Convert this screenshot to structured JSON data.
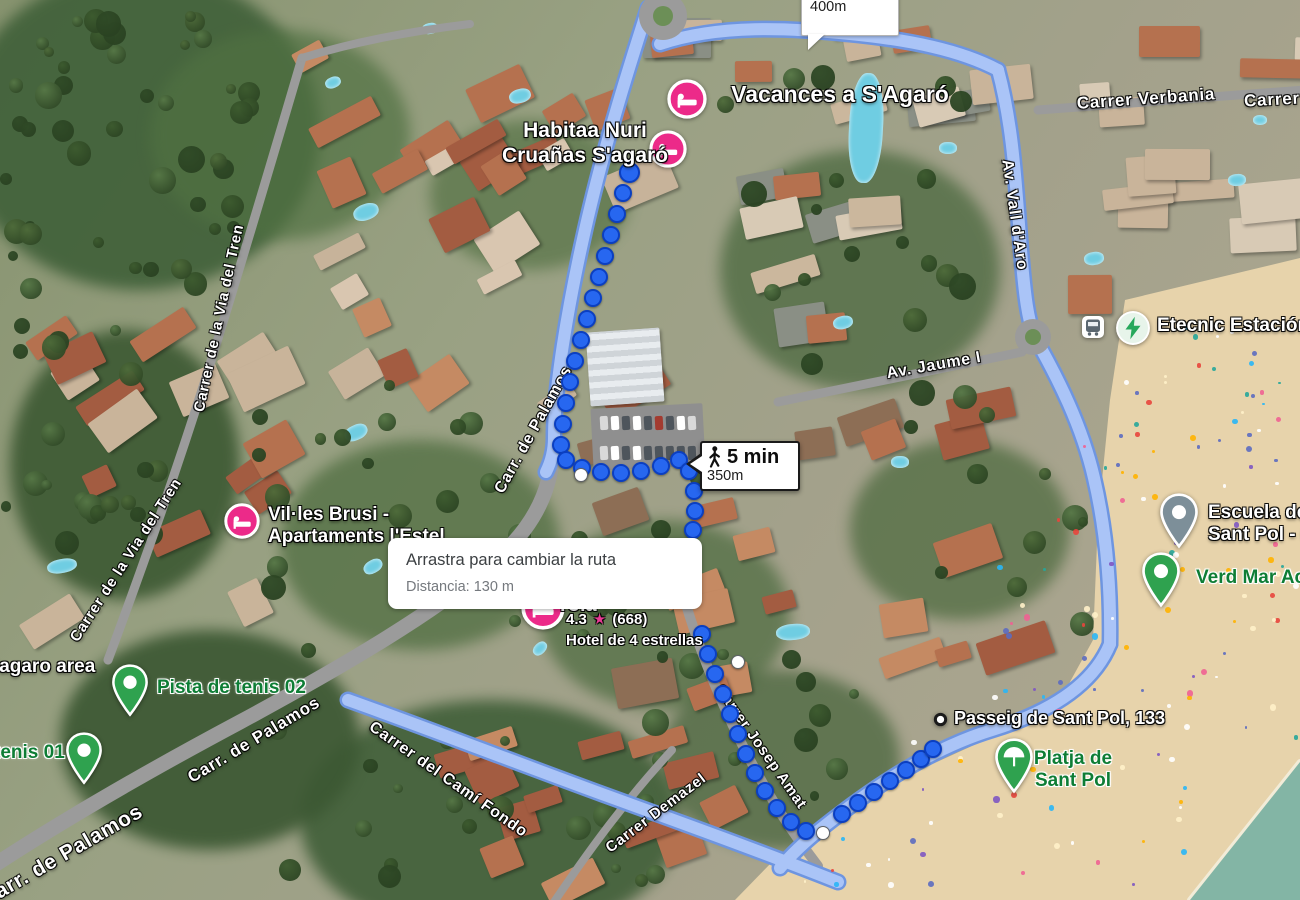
{
  "tooltip": {
    "line1": "Arrastra para cambiar la ruta",
    "line2": "Distancia: 130 m"
  },
  "badge_primary": {
    "time": "5 min",
    "distance": "350m"
  },
  "badge_secondary": {
    "time": "6 min",
    "distance": "400m"
  },
  "hotel_info": {
    "name_fragment": "rola",
    "rating": "4.3",
    "star": "★",
    "reviews": "(668)",
    "subtitle": "Hotel de 4 estrellas"
  },
  "streets": [
    {
      "label": "Carrer de la Via del Tren",
      "x": 219,
      "y": 318,
      "rot": -78,
      "fs": 15
    },
    {
      "label": "Carrer de la Via del Tren",
      "x": 126,
      "y": 560,
      "rot": -57,
      "fs": 15
    },
    {
      "label": "Carr. de Palamos",
      "x": 534,
      "y": 430,
      "rot": -61,
      "fs": 16
    },
    {
      "label": "Carr. de Palamos",
      "x": 254,
      "y": 740,
      "rot": -31,
      "fs": 17
    },
    {
      "label": "Carr. de Palamos",
      "x": 62,
      "y": 856,
      "rot": -30,
      "fs": 21,
      "big": true
    },
    {
      "label": "Carrer del Camí Fondo",
      "x": 448,
      "y": 780,
      "rot": 35,
      "fs": 16
    },
    {
      "label": "Carrer Demazel",
      "x": 656,
      "y": 813,
      "rot": -37,
      "fs": 15
    },
    {
      "label": "Carrer Josep Amat",
      "x": 761,
      "y": 747,
      "rot": 55,
      "fs": 15
    },
    {
      "label": "Av. Jaume I",
      "x": 934,
      "y": 366,
      "rot": -10,
      "fs": 16
    },
    {
      "label": "Av. Vall d'Aro",
      "x": 1014,
      "y": 215,
      "rot": 82,
      "fs": 16
    },
    {
      "label": "Carrer Verbania",
      "x": 1146,
      "y": 99,
      "rot": -4,
      "fs": 17
    },
    {
      "label": "Carrer",
      "x": 1272,
      "y": 100,
      "rot": -3,
      "fs": 17
    }
  ],
  "pois": [
    {
      "id": "vacances-sagaro",
      "lines": [
        "Vacances a S'Agaró"
      ],
      "style": "white",
      "fs": 23,
      "x": 840,
      "y": 95,
      "align": "center",
      "pin": {
        "type": "hotel",
        "x": 687,
        "y": 99,
        "s": 40
      }
    },
    {
      "id": "habitaa-nuri",
      "lines": [
        "Habitaa Nuri",
        "Cruañas S'agaró"
      ],
      "style": "white",
      "fs": 21,
      "x": 585,
      "y": 144,
      "align": "center",
      "pin": {
        "type": "hotel",
        "x": 668,
        "y": 149,
        "s": 38
      }
    },
    {
      "id": "villes-brusi",
      "lines": [
        "Vil·les Brusi -",
        "Apartaments l'Estel"
      ],
      "style": "white",
      "fs": 19,
      "x": 268,
      "y": 526,
      "align": "left",
      "pin": {
        "type": "hotel",
        "x": 242,
        "y": 521,
        "s": 36
      }
    },
    {
      "id": "pista-de-tenis-02",
      "lines": [
        "Pista de tenis 02"
      ],
      "style": "green",
      "fs": 19,
      "x": 157,
      "y": 688,
      "align": "left",
      "pin": {
        "type": "pin-green",
        "x": 130,
        "y": 682,
        "s": 38
      }
    },
    {
      "id": "tenis-01",
      "lines": [
        "tenis 01"
      ],
      "style": "green",
      "fs": 19,
      "x": -6,
      "y": 753,
      "align": "left",
      "pin": {
        "type": "pin-green",
        "x": 84,
        "y": 750,
        "s": 38
      }
    },
    {
      "id": "sagaro-area",
      "lines": [
        "S'agaro area"
      ],
      "style": "white",
      "fs": 19,
      "x": -18,
      "y": 667,
      "align": "left"
    },
    {
      "id": "passeig-sant-pol-133",
      "lines": [
        "Passeig de Sant Pol, 133"
      ],
      "style": "white",
      "fs": 18,
      "x": 954,
      "y": 719,
      "align": "left",
      "pin": {
        "type": "ring",
        "x": 940,
        "y": 719,
        "s": 15
      }
    },
    {
      "id": "platja-de-sant-pol",
      "lines": [
        "Platja de",
        "Sant Pol"
      ],
      "style": "green",
      "fs": 19,
      "x": 1073,
      "y": 770,
      "align": "center",
      "pin": {
        "type": "umbrella",
        "x": 1014,
        "y": 757,
        "s": 40
      }
    },
    {
      "id": "etecnic-estacion",
      "lines": [
        "Etecnic Estación"
      ],
      "style": "white",
      "fs": 19,
      "x": 1157,
      "y": 326,
      "align": "left",
      "pin": {
        "type": "bolt",
        "x": 1133,
        "y": 328,
        "s": 36
      }
    },
    {
      "id": "bus-stop",
      "lines": [],
      "style": "white",
      "fs": 19,
      "x": 0,
      "y": 0,
      "align": "left",
      "pin": {
        "type": "bus",
        "x": 1093,
        "y": 327,
        "s": 24
      }
    },
    {
      "id": "escuela-sant-pol",
      "lines": [
        "Escuela de",
        "Sant Pol - C"
      ],
      "style": "white",
      "fs": 19,
      "x": 1208,
      "y": 524,
      "align": "left",
      "pin": {
        "type": "pin-gray",
        "x": 1179,
        "y": 512,
        "s": 40
      }
    },
    {
      "id": "verd-mar",
      "lines": [
        "Verd Mar Act"
      ],
      "style": "green",
      "fs": 19,
      "x": 1196,
      "y": 578,
      "align": "left",
      "pin": {
        "type": "pin-green",
        "x": 1161,
        "y": 571,
        "s": 40
      }
    },
    {
      "id": "hotel-pin-hidden",
      "lines": [],
      "style": "white",
      "fs": 19,
      "x": 0,
      "y": 0,
      "align": "left",
      "pin": {
        "type": "hotel",
        "x": 543,
        "y": 608,
        "s": 44
      }
    }
  ],
  "route": {
    "dots": [
      [
        627,
        170
      ],
      [
        621,
        191
      ],
      [
        615,
        212
      ],
      [
        609,
        233
      ],
      [
        603,
        254
      ],
      [
        597,
        275
      ],
      [
        591,
        296
      ],
      [
        585,
        317
      ],
      [
        579,
        338
      ],
      [
        573,
        359
      ],
      [
        568,
        380
      ],
      [
        564,
        401
      ],
      [
        561,
        422
      ],
      [
        559,
        443
      ],
      [
        564,
        458
      ],
      [
        580,
        466
      ],
      [
        599,
        470
      ],
      [
        619,
        471
      ],
      [
        639,
        469
      ],
      [
        659,
        464
      ],
      [
        677,
        458
      ],
      [
        687,
        469
      ],
      [
        692,
        489
      ],
      [
        693,
        509
      ],
      [
        691,
        528
      ],
      [
        700,
        632
      ],
      [
        706,
        652
      ],
      [
        713,
        672
      ],
      [
        721,
        692
      ],
      [
        728,
        712
      ],
      [
        736,
        732
      ],
      [
        744,
        752
      ],
      [
        753,
        771
      ],
      [
        763,
        789
      ],
      [
        775,
        806
      ],
      [
        789,
        820
      ],
      [
        804,
        829
      ],
      [
        840,
        812
      ],
      [
        856,
        801
      ],
      [
        872,
        790
      ],
      [
        888,
        779
      ],
      [
        904,
        768
      ],
      [
        919,
        757
      ],
      [
        931,
        747
      ]
    ],
    "waypoints": [
      [
        580,
        474
      ],
      [
        737,
        661
      ],
      [
        822,
        832
      ]
    ]
  },
  "colors": {
    "route_dot": "#2767f0",
    "route_dot_border": "#0b3fc1",
    "road_highlight": "#aac4f7",
    "road_highlight_border": "#6e95e0",
    "road": "#9b9b9b",
    "pin_pink": "#ec2a89",
    "pin_green": "#2fa24f",
    "pin_gray": "#7d8f99",
    "bolt_green": "#27a85c",
    "label_green": "#0e7d35",
    "sea": "#83b5a5",
    "sand": "#e7d3ab"
  }
}
